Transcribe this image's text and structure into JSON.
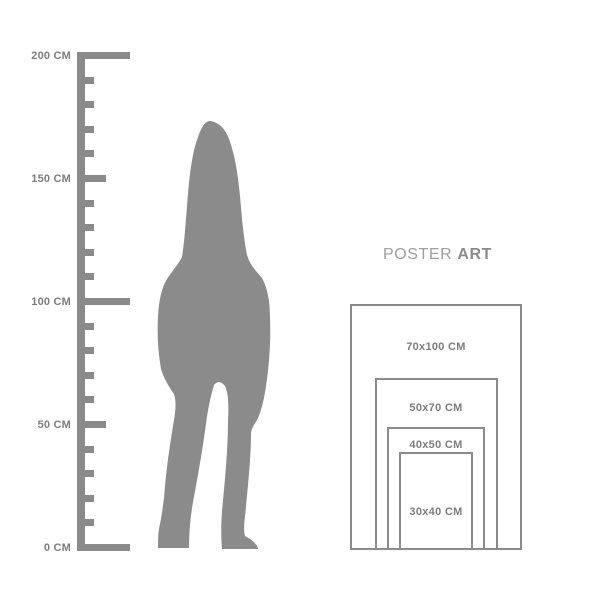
{
  "background": "#ffffff",
  "colors": {
    "figure": "#8b8b8b",
    "ruler": "#8a8a8a",
    "ruler_label": "#7d7d7d",
    "poster_border": "#8a8a8a",
    "poster_label": "#7d7d7d",
    "title_regular": "#9e9e9e",
    "title_bold": "#8a8a8a"
  },
  "ruler": {
    "unit": "CM",
    "min_cm": 0,
    "max_cm": 200,
    "tick_step_cm": 10,
    "labels": [
      {
        "value_cm": 200,
        "text": "200 CM"
      },
      {
        "value_cm": 150,
        "text": "150 CM"
      },
      {
        "value_cm": 100,
        "text": "100 CM"
      },
      {
        "value_cm": 50,
        "text": "50 CM"
      },
      {
        "value_cm": 0,
        "text": "0 CM"
      }
    ]
  },
  "figure": {
    "icon": "woman-silhouette"
  },
  "poster_guide": {
    "title": {
      "regular": "POSTER",
      "bold": "ART"
    },
    "sizes": [
      {
        "label": "70x100 CM",
        "width_cm": 70,
        "height_cm": 100
      },
      {
        "label": "50x70 CM",
        "width_cm": 50,
        "height_cm": 70
      },
      {
        "label": "40x50 CM",
        "width_cm": 40,
        "height_cm": 50
      },
      {
        "label": "30x40 CM",
        "width_cm": 30,
        "height_cm": 40
      }
    ]
  }
}
